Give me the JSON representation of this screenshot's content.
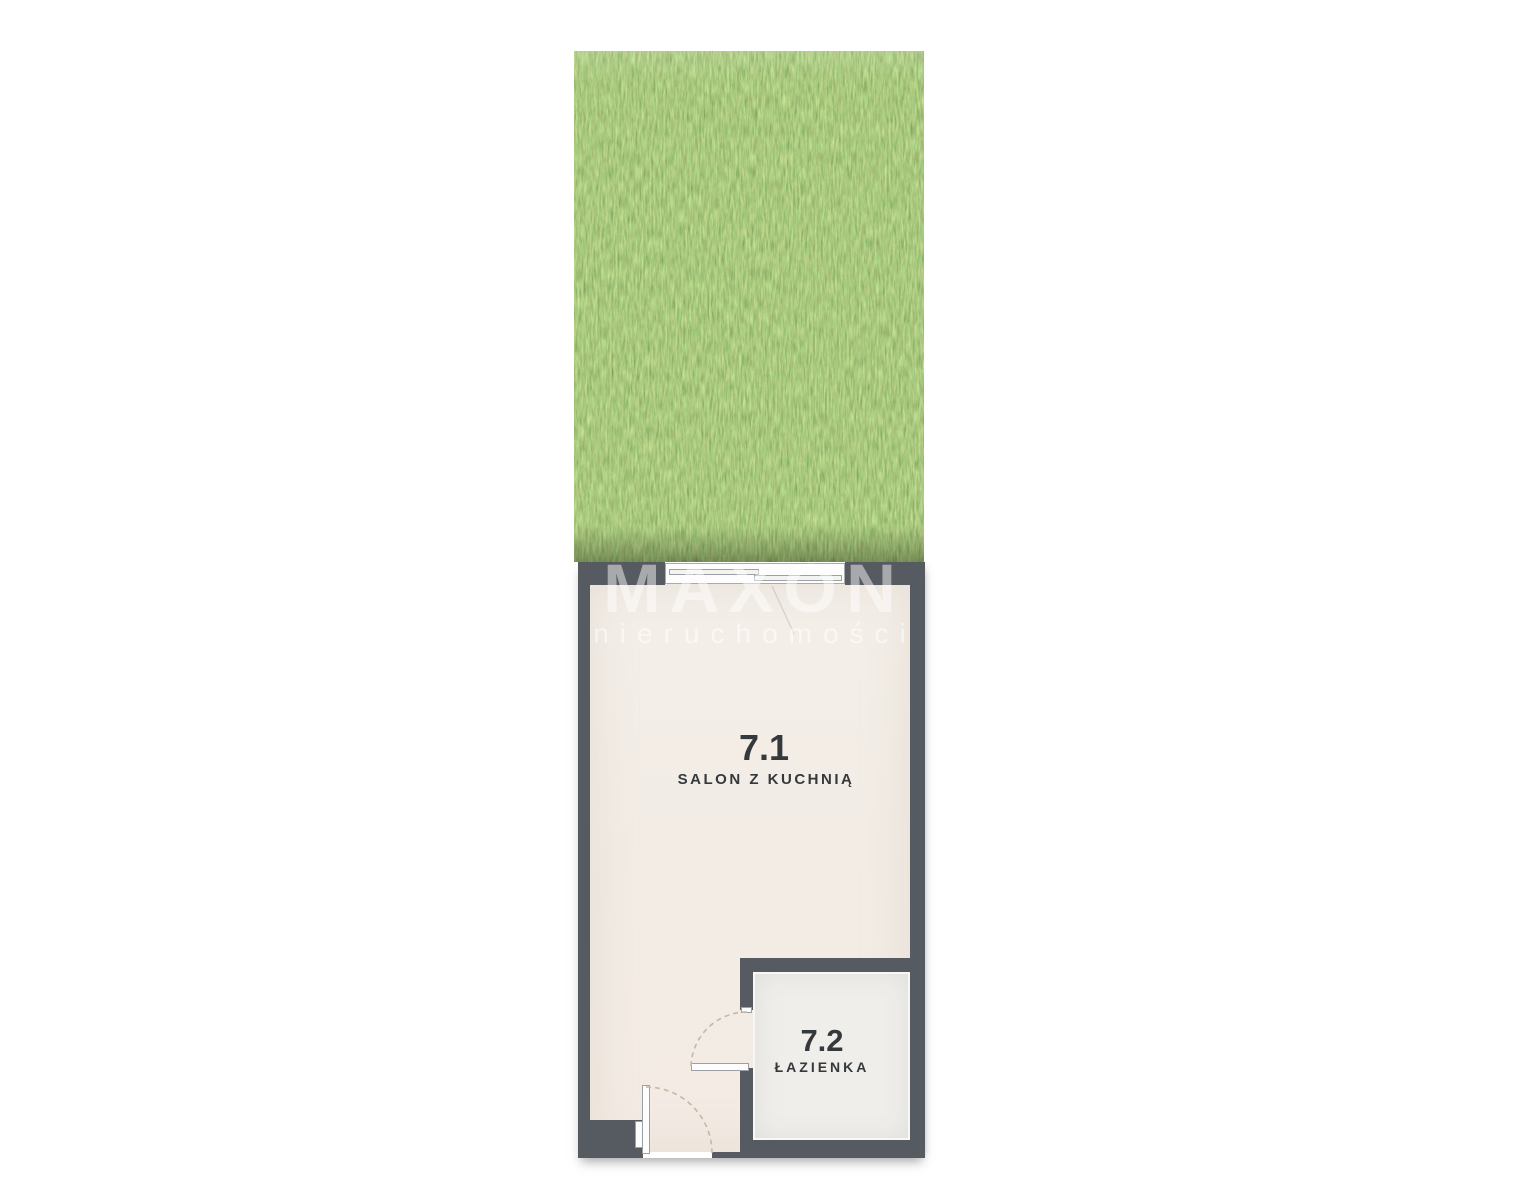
{
  "watermark": {
    "brand": "MAXON",
    "subtitle": "nieruchomości"
  },
  "rooms": [
    {
      "id": "7.1",
      "name": "SALON Z KUCHNIĄ"
    },
    {
      "id": "7.2",
      "name": "ŁAZIENKA"
    }
  ],
  "features": {
    "garden": "grass terrace",
    "balcony_window": "sliding balcony door",
    "entrance_door": "entrance door with swing arc",
    "bathroom_door": "bathroom door with swing arc"
  },
  "colors": {
    "wall": "#565b61",
    "floor_main": "#f2ece5",
    "floor_bath": "#f0eeea",
    "grass_base": "#669140",
    "label": "#35393c",
    "watermark": "rgba(255,255,255,0.48)",
    "watermark_sub": "rgba(255,255,255,0.55)"
  }
}
